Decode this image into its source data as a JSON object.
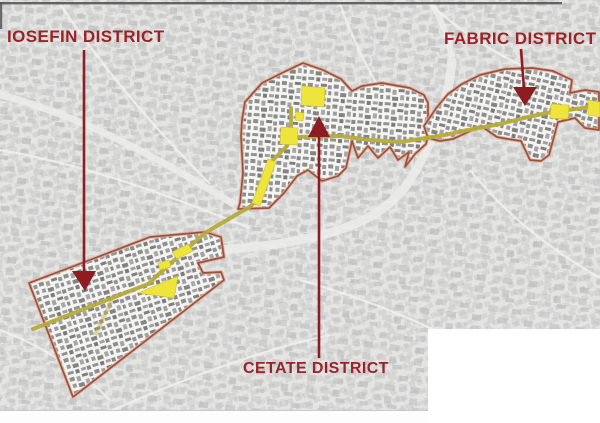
{
  "map": {
    "type": "city-district-overview-map",
    "districts": [
      {
        "id": "iosefin",
        "label": "IOSEFIN DISTRICT"
      },
      {
        "id": "cetate",
        "label": "CETATE DISTRICT"
      },
      {
        "id": "fabric",
        "label": "FABRIC DISTRICT"
      }
    ]
  },
  "colors": {
    "label_text": "#9b2226",
    "arrow": "#8e1c20",
    "district_boundary": "#a0503a",
    "boundary_halo": "#d9b29e",
    "route": "#b5ab3a",
    "route_highlight": "#efe43b",
    "map_base": "#e3e3e2",
    "cover_box": "#ffffff"
  }
}
